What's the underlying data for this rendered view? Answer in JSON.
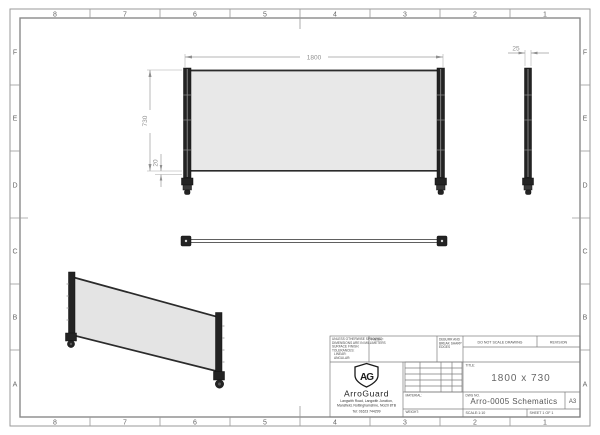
{
  "border": {
    "cols": [
      "8",
      "7",
      "6",
      "5",
      "4",
      "3",
      "2",
      "1"
    ],
    "rows": [
      "F",
      "E",
      "D",
      "C",
      "B",
      "A"
    ]
  },
  "dimensions": {
    "width": "1800",
    "height": "730",
    "bottom_offset": "20",
    "post_width": "25"
  },
  "title_block": {
    "tolerance_note": [
      "UNLESS OTHERWISE SPECIFIED:",
      "DIMENSIONS ARE IN MILLIMETERS",
      "SURFACE FINISH:",
      "TOLERANCES:",
      "   LINEAR:",
      "   ANGULAR:"
    ],
    "finish_label": "FINISH:",
    "deburr_note": [
      "DEBURR AND",
      "BREAK SHARP",
      "EDGES"
    ],
    "do_not_scale": "DO NOT SCALE DRAWING",
    "revision_label": "REVISION",
    "title_label": "TITLE:",
    "title": "1800 x 730",
    "material_label": "MATERIAL:",
    "weight_label": "WEIGHT:",
    "dwg_no_label": "DWG NO.",
    "dwg_no": "Arro-0005 Schematics",
    "paper_size": "A3",
    "scale_label": "SCALE:1:10",
    "sheet_label": "SHEET 1 OF 1",
    "company": {
      "monogram": "AG",
      "name": "ArroGuard",
      "address_line1": "Langwith Road, Langwith Junction,",
      "address_line2": "Mansfield, Nottinghamshire, NG20 8TB",
      "phone": "Tel: 01623 744299"
    }
  },
  "colors": {
    "panel_fill": "#e8e8e8",
    "frame_dark": "#232323",
    "dim_gray": "#8f8f8f",
    "border_gray": "#9a9a9a"
  }
}
